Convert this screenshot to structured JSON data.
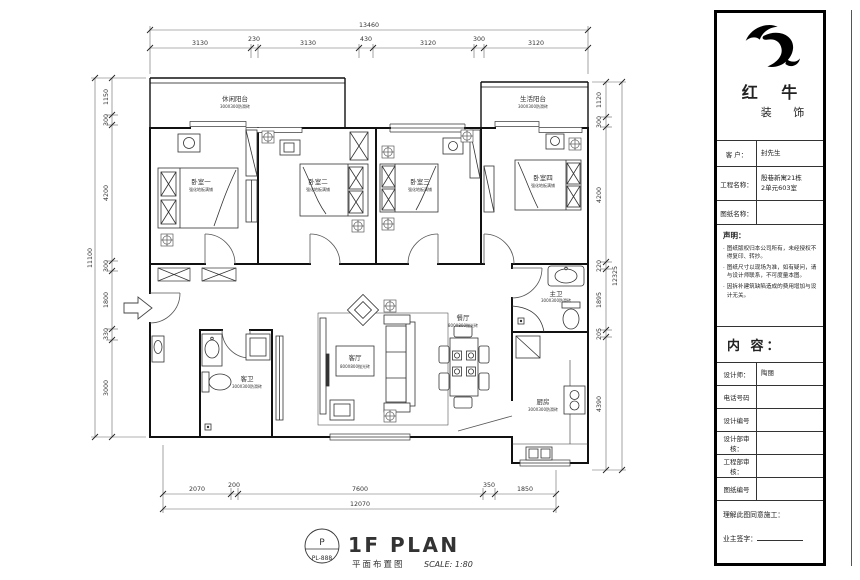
{
  "plan": {
    "rooms": {
      "balcony_left": {
        "name": "休闲阳台",
        "note": "300X300防滑砖"
      },
      "balcony_right": {
        "name": "生活阳台",
        "note": "300X300防滑砖"
      },
      "bedroom1": {
        "name": "卧室一",
        "note": "强化地板满铺"
      },
      "bedroom2": {
        "name": "卧室二",
        "note": "强化地板满铺"
      },
      "bedroom3": {
        "name": "卧室三",
        "note": "强化地板满铺"
      },
      "bedroom4": {
        "name": "卧室四",
        "note": "强化地板满铺"
      },
      "living": {
        "name": "客厅",
        "note": "800X800抛光砖"
      },
      "dining": {
        "name": "餐厅",
        "note": "800X800抛光砖"
      },
      "kitchen": {
        "name": "厨房",
        "note": "300X300防滑砖"
      },
      "bath_master": {
        "name": "主卫",
        "note": "300X300防滑砖"
      },
      "bath_guest": {
        "name": "客卫",
        "note": "300X300防滑砖"
      }
    },
    "dims": {
      "top": {
        "total": "13460",
        "segs": [
          "3130",
          "230",
          "3130",
          "430",
          "3120",
          "300",
          "3120"
        ]
      },
      "bottom": {
        "total": "12070",
        "segs": [
          "2070",
          "200",
          "7600",
          "350",
          "1850"
        ]
      },
      "left": {
        "total": "11100",
        "segs": [
          "1150",
          "300",
          "4200",
          "300",
          "1800",
          "330",
          "3000"
        ]
      },
      "right": {
        "total": "12325",
        "segs": [
          "1120",
          "300",
          "4200",
          "220",
          "1895",
          "205",
          "4390"
        ]
      }
    },
    "caption": {
      "letter": "P",
      "code": "PL-888",
      "title": "1F PLAN",
      "name": "平面布置图",
      "scale": "SCALE: 1:80"
    }
  },
  "titleblock": {
    "brand_line1": "红 牛",
    "brand_line2": "装 饰",
    "customer_label": "客 户：",
    "customer": "封先生",
    "project_label": "工程名称：",
    "project_line1": "殷巷新寓21栋",
    "project_line2": "2单元603室",
    "drawing_label": "图纸名称：",
    "drawing": "",
    "statement_title": "声明：",
    "statements": [
      "图纸版权归本公司所有，未经授权不得复印、转抄。",
      "图纸尺寸以现场为准，如有疑问，请与设计师联系，不可度量本图。",
      "因拆补建筑缺陷造成的费用增加与设计无关。"
    ],
    "content_label": "内 容：",
    "fields": [
      {
        "label": "设计师：",
        "value": "陶丽"
      },
      {
        "label": "电话号码",
        "value": ""
      },
      {
        "label": "设计编号",
        "value": ""
      },
      {
        "label": "设计部审核：",
        "value": ""
      },
      {
        "label": "工程部审核：",
        "value": ""
      },
      {
        "label": "图纸编号",
        "value": ""
      }
    ],
    "agree_label": "理解此图同意施工：",
    "sign_label": "业主签字："
  }
}
